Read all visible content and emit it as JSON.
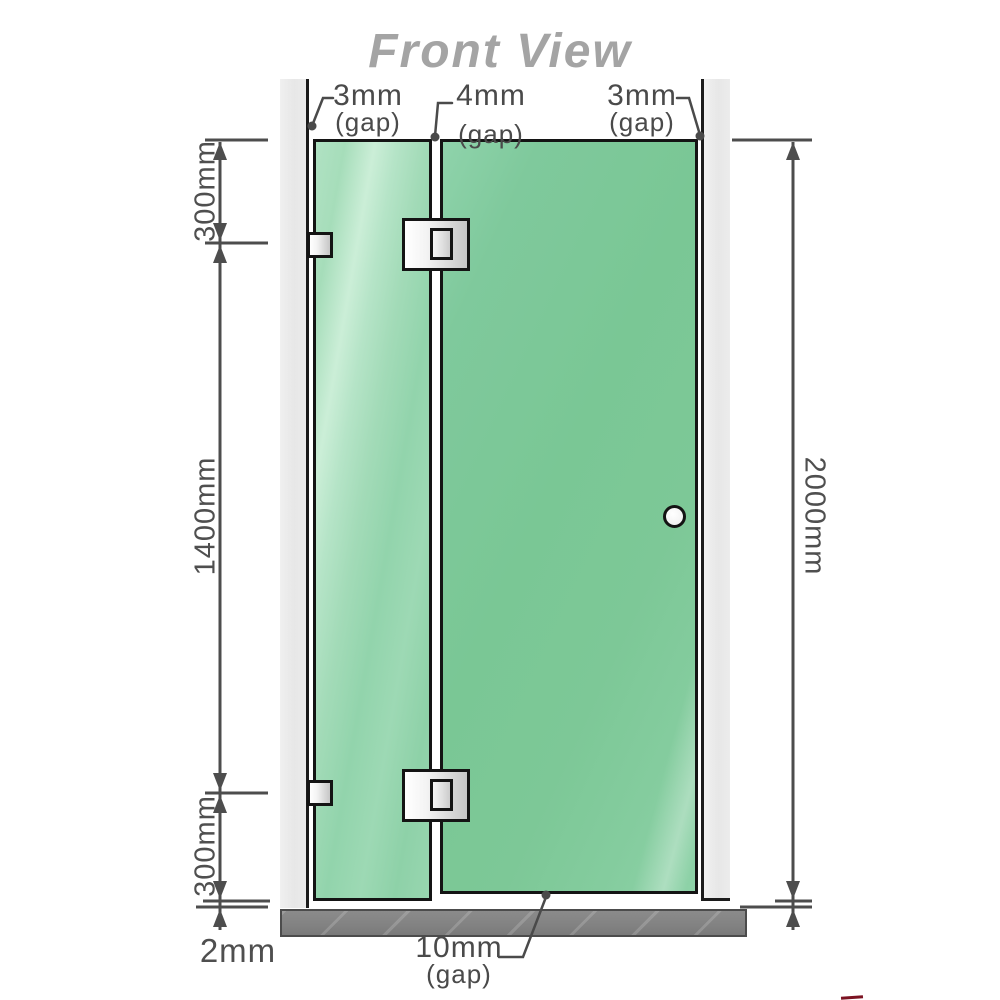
{
  "title": "Front View",
  "annotations": {
    "gap_top_left": {
      "value": "3mm",
      "suffix": "(gap)"
    },
    "gap_top_middle": {
      "value": "4mm",
      "suffix": "(gap)"
    },
    "gap_top_right": {
      "value": "3mm",
      "suffix": "(gap)"
    },
    "gap_bottom_door": {
      "value": "10mm",
      "suffix": "(gap)"
    },
    "gap_floor": "2mm"
  },
  "dimensions": {
    "left_top": "300mm",
    "left_middle": "1400mm",
    "left_bottom": "300mm",
    "right_total": "2000mm"
  },
  "colors": {
    "glass_fixed": "#a6ddba",
    "glass_door": "#7ac795",
    "wall": "#e9e9e9",
    "floor": "#828282",
    "line": "#4d4d4d",
    "label_text": "#4a4a4a",
    "title_text": "#a4a4a4",
    "hardware": "#e8e8e8",
    "red_fragment": "#7c1322"
  }
}
